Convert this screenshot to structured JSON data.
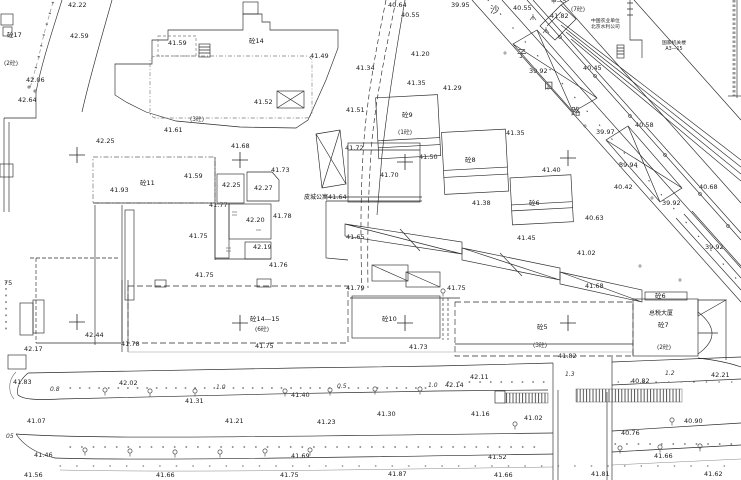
{
  "colors": {
    "ink": "#2a2a2a",
    "gray_dash": "#8a8a8a",
    "background": "#ffffff"
  },
  "street": {
    "name": "沙子口路",
    "chars": [
      {
        "ch": "沙",
        "x": 490,
        "y": 6
      },
      {
        "ch": "子",
        "x": 517,
        "y": 50
      },
      {
        "ch": "口",
        "x": 544,
        "y": 82
      },
      {
        "ch": "路",
        "x": 571,
        "y": 108
      }
    ]
  },
  "organizations": [
    {
      "x": 591,
      "y": 19,
      "lines": [
        "中国农业单位",
        "北京水利公司"
      ]
    },
    {
      "x": 662,
      "y": 41,
      "lines": [
        "国家机关楼",
        "A3—15"
      ]
    }
  ],
  "named_places": [
    {
      "t": "皮城公寓",
      "x": 304,
      "y": 195
    },
    {
      "t": "总税大厦",
      "x": 649,
      "y": 311
    }
  ],
  "building_labels": [
    {
      "t": "砼17",
      "x": 7,
      "y": 32
    },
    {
      "t": "砼14",
      "x": 249,
      "y": 38
    },
    {
      "t": "砼11",
      "x": 140,
      "y": 180
    },
    {
      "t": "砼9",
      "x": 402,
      "y": 112
    },
    {
      "t": "砼8",
      "x": 465,
      "y": 157
    },
    {
      "t": "砼6",
      "x": 529,
      "y": 200
    },
    {
      "t": "砼14—15",
      "x": 250,
      "y": 316
    },
    {
      "t": "砼10",
      "x": 382,
      "y": 316
    },
    {
      "t": "砼5",
      "x": 537,
      "y": 324
    },
    {
      "t": "砼6",
      "x": 655,
      "y": 293
    },
    {
      "t": "砼7",
      "x": 658,
      "y": 322
    }
  ],
  "floor_notes": [
    {
      "t": "(2砼)",
      "x": 4,
      "y": 62
    },
    {
      "t": "(3砼)",
      "x": 190,
      "y": 118
    },
    {
      "t": "(1砼)",
      "x": 398,
      "y": 131
    },
    {
      "t": "(6砼)",
      "x": 255,
      "y": 328
    },
    {
      "t": "(3砼)",
      "x": 533,
      "y": 344
    },
    {
      "t": "(2砼)",
      "x": 657,
      "y": 346
    },
    {
      "t": "(7砼)",
      "x": 571,
      "y": 8
    },
    {
      "t": "甲—5",
      "x": 551,
      "y": 0
    }
  ],
  "road_widths": [
    {
      "t": "0.8",
      "x": 50,
      "y": 387
    },
    {
      "t": "1.0",
      "x": 216,
      "y": 385
    },
    {
      "t": "0.5",
      "x": 337,
      "y": 384
    },
    {
      "t": "1.0",
      "x": 428,
      "y": 383
    },
    {
      "t": "1.3",
      "x": 565,
      "y": 372
    },
    {
      "t": "1.2",
      "x": 665,
      "y": 371
    },
    {
      "t": "05",
      "x": 6,
      "y": 434
    }
  ],
  "spot_elevations": [
    {
      "t": "42.22",
      "x": 68,
      "y": 2
    },
    {
      "t": "42.59",
      "x": 70,
      "y": 33
    },
    {
      "t": "41.59",
      "x": 168,
      "y": 40
    },
    {
      "t": "42.06",
      "x": 26,
      "y": 77
    },
    {
      "t": "42.64",
      "x": 18,
      "y": 97
    },
    {
      "t": "40.64",
      "x": 388,
      "y": 2
    },
    {
      "t": "40.55",
      "x": 401,
      "y": 12
    },
    {
      "t": "39.95",
      "x": 451,
      "y": 2
    },
    {
      "t": "40.55",
      "x": 513,
      "y": 5
    },
    {
      "t": "41.82",
      "x": 550,
      "y": 13
    },
    {
      "t": "39.92",
      "x": 529,
      "y": 68
    },
    {
      "t": "40.45",
      "x": 583,
      "y": 65
    },
    {
      "t": "39.97",
      "x": 596,
      "y": 129
    },
    {
      "t": "40.58",
      "x": 635,
      "y": 122
    },
    {
      "t": "41.35",
      "x": 506,
      "y": 130
    },
    {
      "t": "41.49",
      "x": 310,
      "y": 53
    },
    {
      "t": "41.52",
      "x": 254,
      "y": 99
    },
    {
      "t": "41.61",
      "x": 164,
      "y": 127
    },
    {
      "t": "42.25",
      "x": 96,
      "y": 138
    },
    {
      "t": "41.93",
      "x": 110,
      "y": 187
    },
    {
      "t": "41.59",
      "x": 184,
      "y": 173
    },
    {
      "t": "42.25",
      "x": 222,
      "y": 182
    },
    {
      "t": "42.27",
      "x": 254,
      "y": 185
    },
    {
      "t": "41.68",
      "x": 231,
      "y": 143
    },
    {
      "t": "41.73",
      "x": 271,
      "y": 167
    },
    {
      "t": "41.77",
      "x": 209,
      "y": 202
    },
    {
      "t": "42.20",
      "x": 246,
      "y": 217
    },
    {
      "t": "41.78",
      "x": 273,
      "y": 213
    },
    {
      "t": "41.75",
      "x": 189,
      "y": 233
    },
    {
      "t": "42.19",
      "x": 253,
      "y": 244
    },
    {
      "t": "41.76",
      "x": 269,
      "y": 262
    },
    {
      "t": "41.75",
      "x": 195,
      "y": 272
    },
    {
      "t": "41.64",
      "x": 328,
      "y": 194
    },
    {
      "t": "41.72",
      "x": 345,
      "y": 145
    },
    {
      "t": "41.50",
      "x": 419,
      "y": 154
    },
    {
      "t": "41.70",
      "x": 380,
      "y": 172
    },
    {
      "t": "41.65",
      "x": 346,
      "y": 234
    },
    {
      "t": "41.38",
      "x": 472,
      "y": 200
    },
    {
      "t": "41.35",
      "x": 407,
      "y": 80
    },
    {
      "t": "41.29",
      "x": 443,
      "y": 85
    },
    {
      "t": "41.20",
      "x": 411,
      "y": 51
    },
    {
      "t": "41.34",
      "x": 356,
      "y": 65
    },
    {
      "t": "41.51",
      "x": 346,
      "y": 107
    },
    {
      "t": "41.40",
      "x": 542,
      "y": 167
    },
    {
      "t": "41.45",
      "x": 517,
      "y": 235
    },
    {
      "t": "40.63",
      "x": 585,
      "y": 215
    },
    {
      "t": "41.02",
      "x": 577,
      "y": 250
    },
    {
      "t": "41.68",
      "x": 585,
      "y": 283
    },
    {
      "t": "39.94",
      "x": 619,
      "y": 162
    },
    {
      "t": "40.42",
      "x": 614,
      "y": 184
    },
    {
      "t": "39.92",
      "x": 662,
      "y": 200
    },
    {
      "t": "40.68",
      "x": 699,
      "y": 184
    },
    {
      "t": "39.92",
      "x": 705,
      "y": 244
    },
    {
      "t": "42.44",
      "x": 85,
      "y": 332
    },
    {
      "t": "42.17",
      "x": 24,
      "y": 346
    },
    {
      "t": "41.78",
      "x": 121,
      "y": 341
    },
    {
      "t": "41.83",
      "x": 13,
      "y": 379
    },
    {
      "t": "42.02",
      "x": 119,
      "y": 380
    },
    {
      "t": "41.31",
      "x": 185,
      "y": 398
    },
    {
      "t": "41.07",
      "x": 27,
      "y": 418
    },
    {
      "t": "41.21",
      "x": 225,
      "y": 418
    },
    {
      "t": "41.23",
      "x": 317,
      "y": 419
    },
    {
      "t": "41.46",
      "x": 34,
      "y": 452
    },
    {
      "t": "41.56",
      "x": 24,
      "y": 472
    },
    {
      "t": "41.66",
      "x": 156,
      "y": 472
    },
    {
      "t": "41.75",
      "x": 280,
      "y": 472
    },
    {
      "t": "41.69",
      "x": 291,
      "y": 453
    },
    {
      "t": "41.79",
      "x": 346,
      "y": 285
    },
    {
      "t": "41.75",
      "x": 447,
      "y": 285
    },
    {
      "t": "41.75",
      "x": 255,
      "y": 343
    },
    {
      "t": "41.73",
      "x": 409,
      "y": 344
    },
    {
      "t": "41.40",
      "x": 291,
      "y": 392
    },
    {
      "t": "41.30",
      "x": 377,
      "y": 411
    },
    {
      "t": "41.16",
      "x": 471,
      "y": 411
    },
    {
      "t": "42.14",
      "x": 445,
      "y": 382
    },
    {
      "t": "42.11",
      "x": 470,
      "y": 374
    },
    {
      "t": "41.82",
      "x": 558,
      "y": 353
    },
    {
      "t": "42.21",
      "x": 711,
      "y": 372
    },
    {
      "t": "40.82",
      "x": 631,
      "y": 378
    },
    {
      "t": "41.02",
      "x": 524,
      "y": 415
    },
    {
      "t": "40.90",
      "x": 684,
      "y": 418
    },
    {
      "t": "40.76",
      "x": 621,
      "y": 430
    },
    {
      "t": "41.52",
      "x": 488,
      "y": 454
    },
    {
      "t": "41.66",
      "x": 654,
      "y": 453
    },
    {
      "t": "41.87",
      "x": 388,
      "y": 471
    },
    {
      "t": "41.66",
      "x": 494,
      "y": 472
    },
    {
      "t": "41.81",
      "x": 591,
      "y": 471
    },
    {
      "t": "41.62",
      "x": 704,
      "y": 471
    },
    {
      "t": "75",
      "x": 4,
      "y": 280
    }
  ]
}
